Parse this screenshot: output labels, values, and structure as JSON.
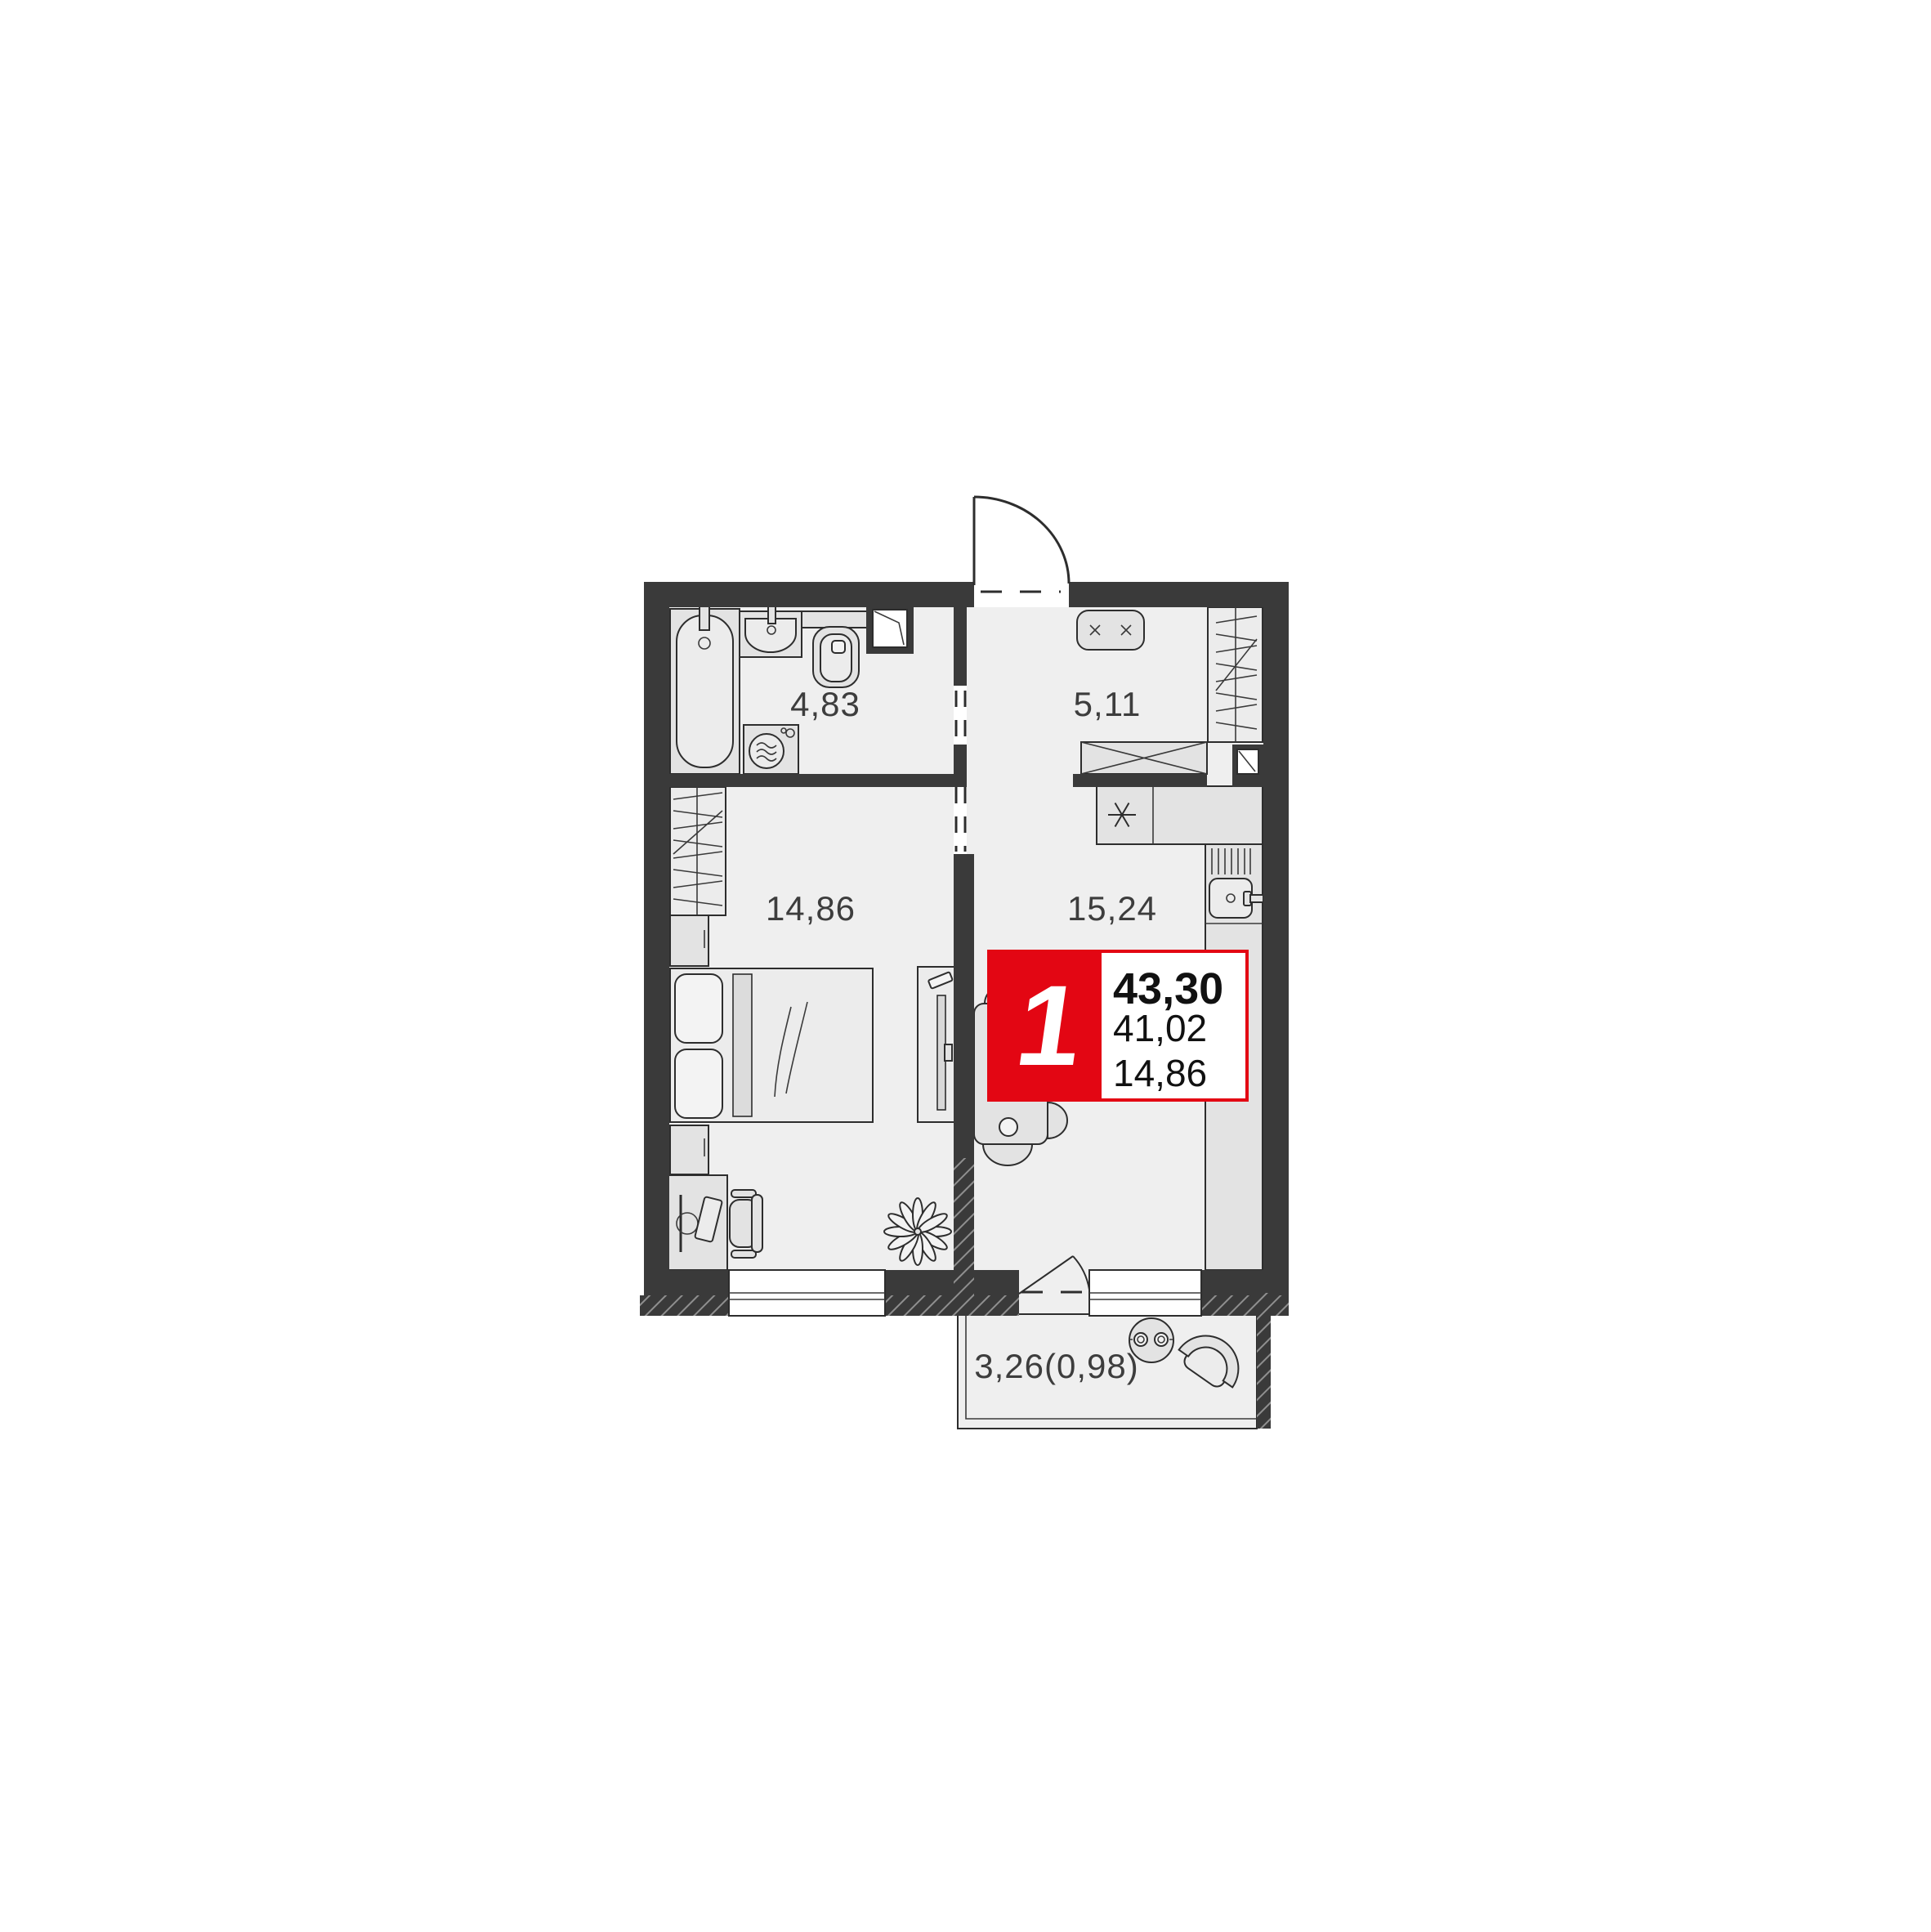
{
  "colors": {
    "background": "#ffffff",
    "wall": "#3a3a3a",
    "floor": "#efefef",
    "furniture": "#e3e3e3",
    "accent_red": "#e30613",
    "label_text": "#3d3d3d",
    "badge_text": "#111111",
    "badge_digit": "#ffffff"
  },
  "rooms": {
    "bathroom": {
      "label": "4,83"
    },
    "hallway": {
      "label": "5,11"
    },
    "bedroom": {
      "label": "14,86"
    },
    "kitchen_living": {
      "label": "15,24"
    },
    "balcony": {
      "label": "3,26(0,98)"
    }
  },
  "badge": {
    "rooms_count": "1",
    "area_lines": [
      "43,30",
      "41,02",
      "14,86"
    ]
  }
}
